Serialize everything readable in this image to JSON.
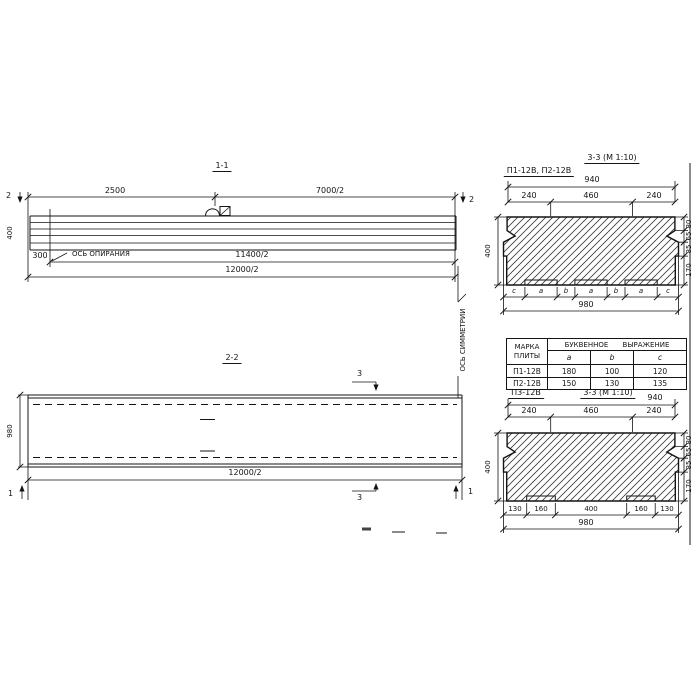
{
  "section_1_1": {
    "title": "1-1",
    "dim_2500": "2500",
    "dim_7000_2": "7000/2",
    "marker_2_left": "2",
    "marker_2_right": "2",
    "height_400": "400",
    "dim_300": "300",
    "support_axis_label": "ОСЬ ОПИРАНИЯ",
    "dim_11400_2": "11400/2",
    "dim_12000_2": "12000/2"
  },
  "section_2_2": {
    "title": "2-2",
    "marker_3_top": "3",
    "marker_3_bottom": "3",
    "marker_1_left": "1",
    "marker_1_right": "1",
    "height_980": "980",
    "dim_12000_2": "12000/2"
  },
  "symmetry_axis_label": "ОСЬ СИММЕТРИИ",
  "section_3_3_top": {
    "plates_label": "П1-12В, П2-12В",
    "title": "3-3 (М 1:10)",
    "dim_940": "940",
    "top_dims": [
      "240",
      "460",
      "240"
    ],
    "height_400": "400",
    "right_dims": [
      "80",
      "65",
      "85",
      "170"
    ],
    "letter_dims": [
      "c",
      "a",
      "b",
      "a",
      "b",
      "a",
      "c"
    ],
    "dim_980": "980"
  },
  "table": {
    "header_mark": "МАРКА ПЛИТЫ",
    "header_expr": "БУКВЕННОЕ ВЫРАЖЕНИЕ",
    "subheaders": [
      "a",
      "b",
      "c"
    ],
    "rows": [
      [
        "П1-12В",
        "180",
        "100",
        "120"
      ],
      [
        "П2-12В",
        "150",
        "130",
        "135"
      ]
    ]
  },
  "section_3_3_bottom": {
    "plate_label": "П3-12В",
    "title": "3-3 (М 1:10)",
    "dim_940": "940",
    "top_dims": [
      "240",
      "460",
      "240"
    ],
    "height_400": "400",
    "right_dims": [
      "80",
      "65",
      "85",
      "170"
    ],
    "bottom_dims": [
      "130",
      "160",
      "400",
      "160",
      "130"
    ],
    "dim_980": "980"
  },
  "ink_color": "#141414"
}
